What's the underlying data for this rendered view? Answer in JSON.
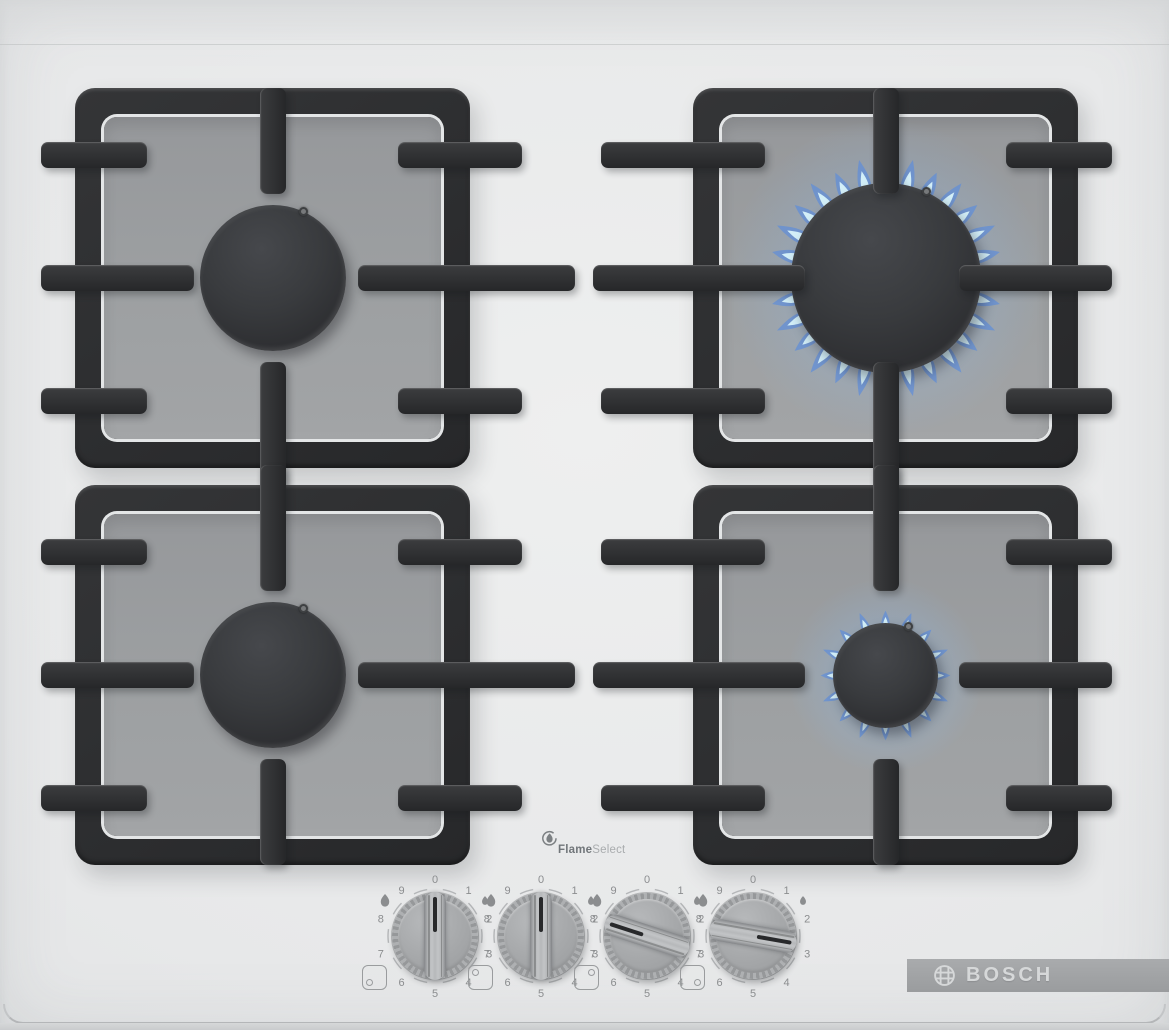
{
  "brand": {
    "name": "BOSCH"
  },
  "feature_logo": {
    "part1": "Flame",
    "part2": "Select"
  },
  "burners": [
    {
      "id": "back-left",
      "label": "back left burner",
      "size": "medium",
      "lit": false,
      "power_level": 0
    },
    {
      "id": "back-right",
      "label": "back right burner",
      "size": "large",
      "lit": true,
      "power_level": 8
    },
    {
      "id": "front-left",
      "label": "front left burner",
      "size": "medium",
      "lit": false,
      "power_level": 0
    },
    {
      "id": "front-right",
      "label": "front right burner",
      "size": "small",
      "lit": true,
      "power_level": 3
    }
  ],
  "controls": {
    "scale_numbers": [
      "0",
      "1",
      "2",
      "3",
      "4",
      "5",
      "6",
      "7",
      "8",
      "9"
    ],
    "knobs": [
      {
        "id": "knob-front-left",
        "burner": "front-left",
        "setting": "0",
        "rotation_deg": 0,
        "dot_corner": "bottom-left"
      },
      {
        "id": "knob-back-left",
        "burner": "back-left",
        "setting": "0",
        "rotation_deg": 0,
        "dot_corner": "top-left"
      },
      {
        "id": "knob-back-right",
        "burner": "back-right",
        "setting": "8",
        "rotation_deg": 288,
        "dot_corner": "top-right"
      },
      {
        "id": "knob-front-right",
        "burner": "front-right",
        "setting": "3",
        "rotation_deg": 100,
        "dot_corner": "bottom-right"
      }
    ]
  },
  "colors": {
    "surface": "#e7e8e9",
    "grate": "#2e2f31",
    "tray": "#9b9da0",
    "flame_core": "#d8f3fa",
    "flame_tip": "#5a87d6",
    "knob": "#a6a8aa",
    "logo_bar": "#a2a4a6",
    "logo_text": "#d6d8d9"
  }
}
